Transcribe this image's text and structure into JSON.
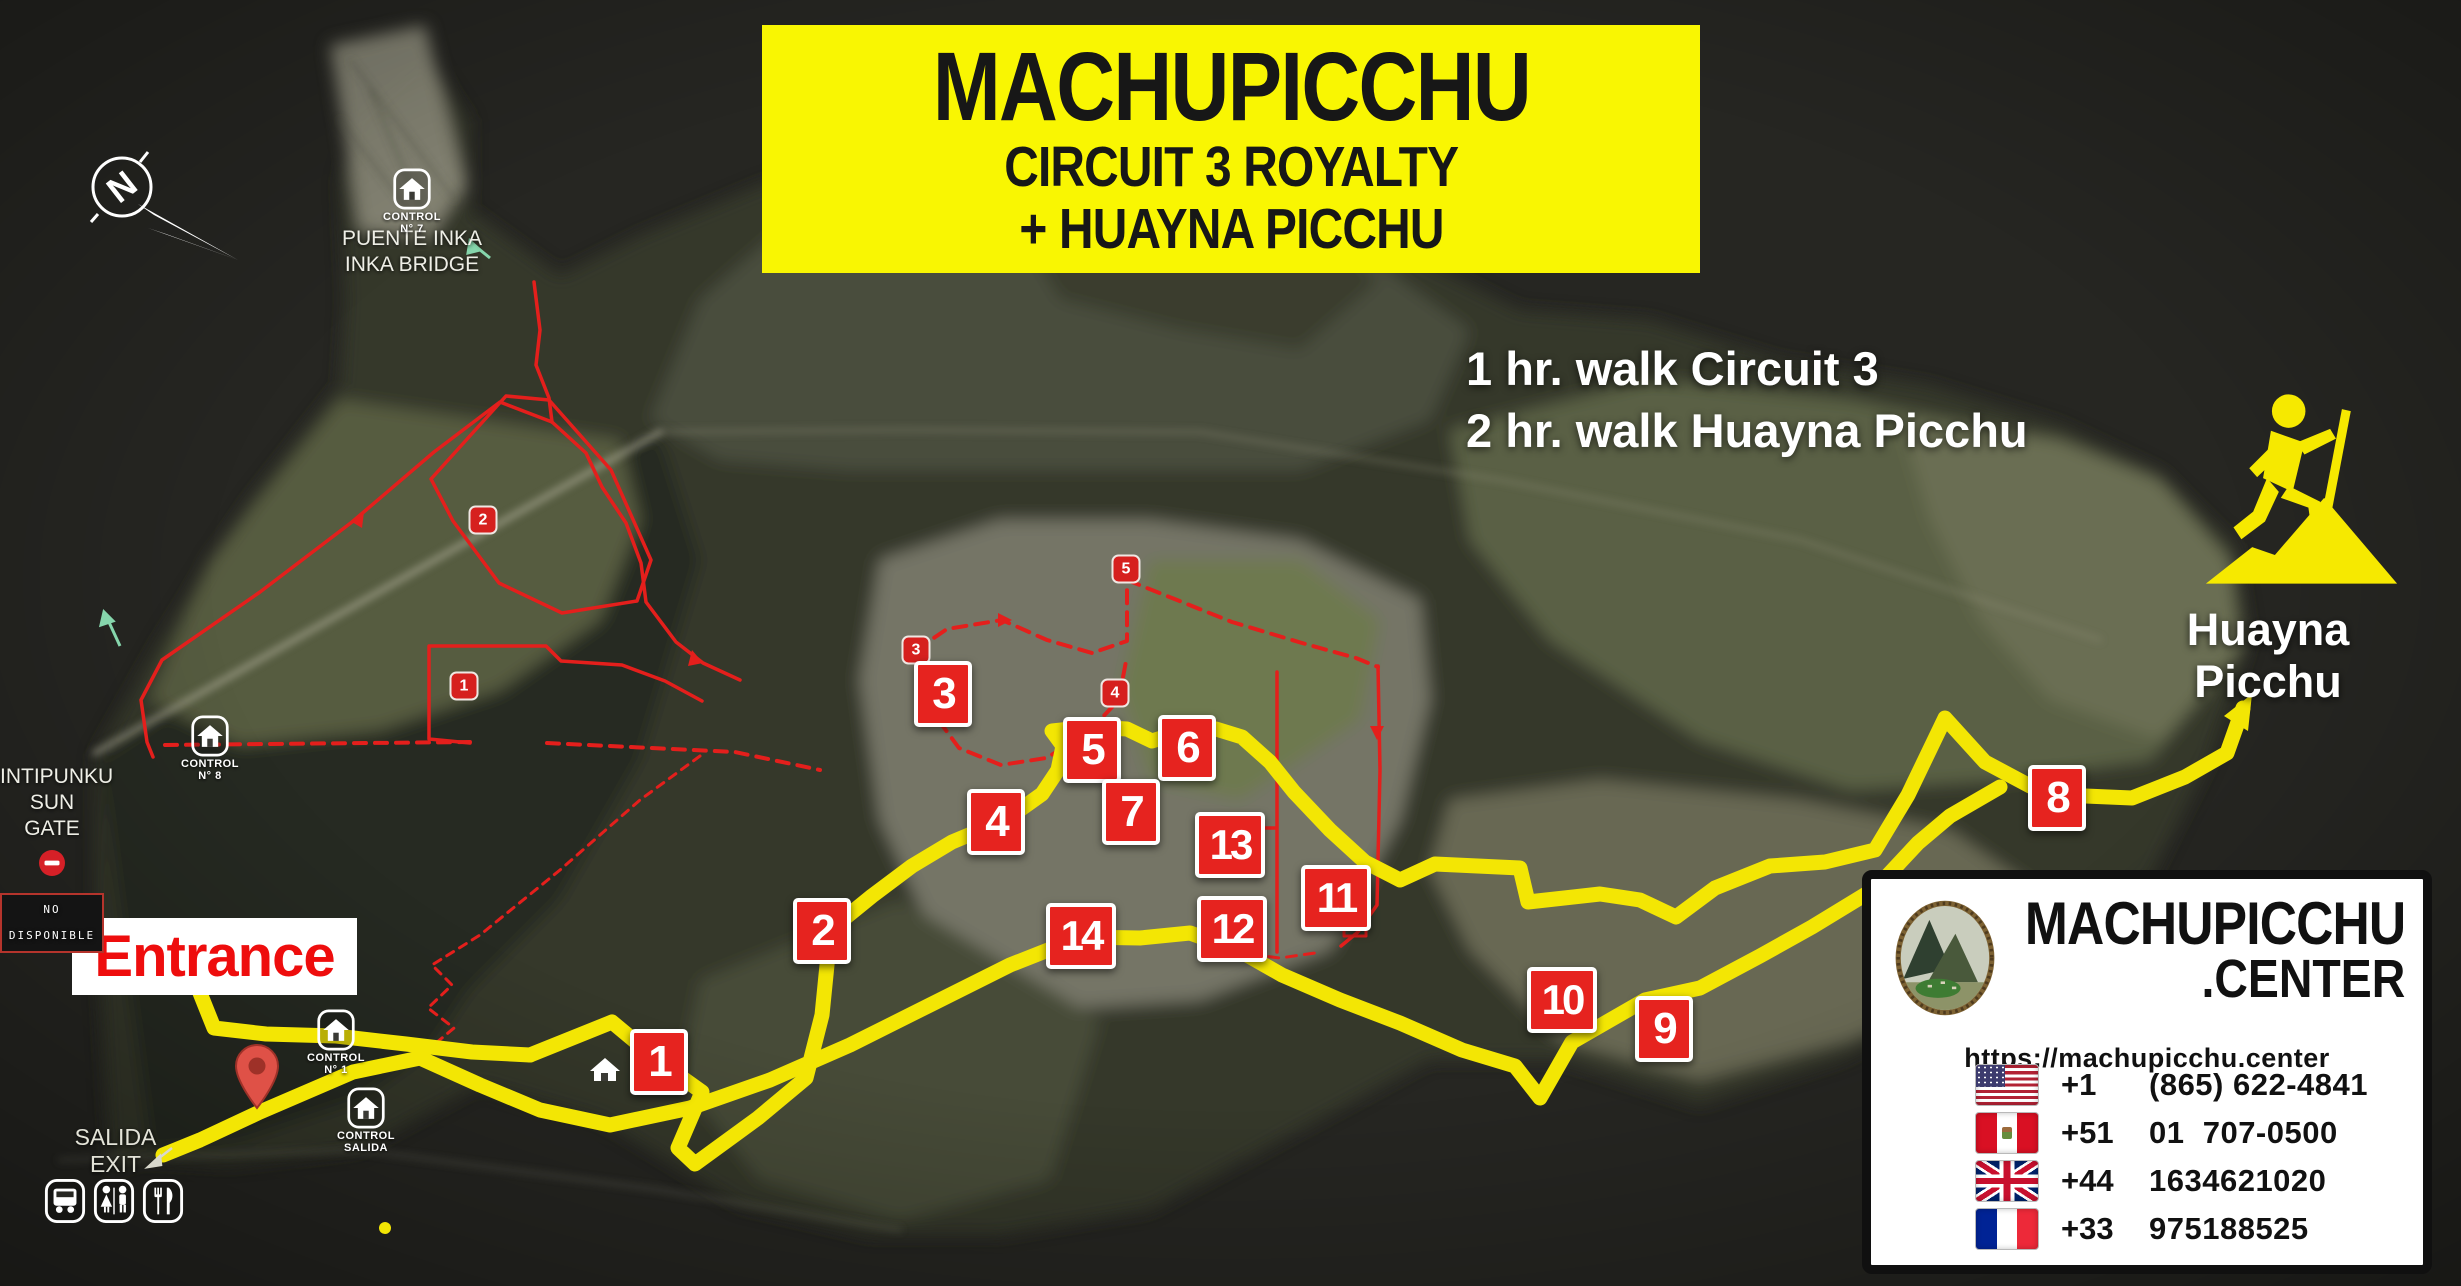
{
  "banner": {
    "title": "MACHUPICCHU",
    "subtitle1": "CIRCUIT 3 ROYALTY",
    "subtitle2": "+ HUAYNA PICCHU"
  },
  "walk_info": {
    "line1": "1 hr. walk Circuit 3",
    "line2": "2 hr. walk Huayna Picchu"
  },
  "huayna": {
    "label": "Huayna Picchu"
  },
  "entrance": {
    "label": "Entrance"
  },
  "exit_label": {
    "line1": "SALIDA",
    "line2": "EXIT"
  },
  "sun_gate": {
    "line1": "INTIPUNKU",
    "line2": "SUN GATE",
    "badge": "NO DISPONIBLE"
  },
  "inka_bridge": {
    "line1": "PUENTE INKA",
    "line2": "INKA BRIDGE"
  },
  "compass": {
    "letter": "N"
  },
  "controls": [
    {
      "id": "control-7",
      "line1": "CONTROL",
      "line2": "N° 7",
      "x": 412,
      "y": 191
    },
    {
      "id": "control-8",
      "line1": "CONTROL",
      "line2": "N° 8",
      "x": 210,
      "y": 738
    },
    {
      "id": "control-1",
      "line1": "CONTROL",
      "line2": "N° 1",
      "x": 336,
      "y": 1032
    },
    {
      "id": "control-salida",
      "line1": "CONTROL",
      "line2": "SALIDA",
      "x": 366,
      "y": 1110
    }
  ],
  "stops": [
    {
      "n": "1",
      "x": 659,
      "y": 1062
    },
    {
      "n": "2",
      "x": 822,
      "y": 931
    },
    {
      "n": "3",
      "x": 943,
      "y": 694
    },
    {
      "n": "4",
      "x": 996,
      "y": 822
    },
    {
      "n": "5",
      "x": 1092,
      "y": 750
    },
    {
      "n": "6",
      "x": 1187,
      "y": 748
    },
    {
      "n": "7",
      "x": 1131,
      "y": 812
    },
    {
      "n": "8",
      "x": 2057,
      "y": 798
    },
    {
      "n": "9",
      "x": 1664,
      "y": 1029
    },
    {
      "n": "10",
      "x": 1562,
      "y": 1000
    },
    {
      "n": "11",
      "x": 1336,
      "y": 898
    },
    {
      "n": "12",
      "x": 1232,
      "y": 929
    },
    {
      "n": "13",
      "x": 1230,
      "y": 845
    },
    {
      "n": "14",
      "x": 1081,
      "y": 936
    }
  ],
  "waypoints": [
    {
      "n": "1",
      "x": 464,
      "y": 686
    },
    {
      "n": "2",
      "x": 483,
      "y": 520
    },
    {
      "n": "3",
      "x": 916,
      "y": 650
    },
    {
      "n": "4",
      "x": 1115,
      "y": 693
    },
    {
      "n": "5",
      "x": 1126,
      "y": 569
    }
  ],
  "contact": {
    "brand_line1": "MACHUPICCHU",
    "brand_line2": ".CENTER",
    "url": "https://machupicchu.center",
    "phones": [
      {
        "flag": "flag-us",
        "code": "+1",
        "number": "(865) 622-4841"
      },
      {
        "flag": "flag-peru",
        "code": "+51",
        "number": "01  707-0500"
      },
      {
        "flag": "flag-uk",
        "code": "+44",
        "number": "1634621020"
      },
      {
        "flag": "flag-france",
        "code": "+33",
        "number": "975188525"
      }
    ]
  },
  "amenities": [
    {
      "icon": "bus-icon"
    },
    {
      "icon": "restroom-icon"
    },
    {
      "icon": "restaurant-icon"
    }
  ],
  "colors": {
    "banner_yellow": "#f9f602",
    "route_yellow": "#f3e604",
    "marker_red": "#e6231f",
    "route_red": "#e41f1c",
    "entrance_red": "#ee0d0d"
  }
}
